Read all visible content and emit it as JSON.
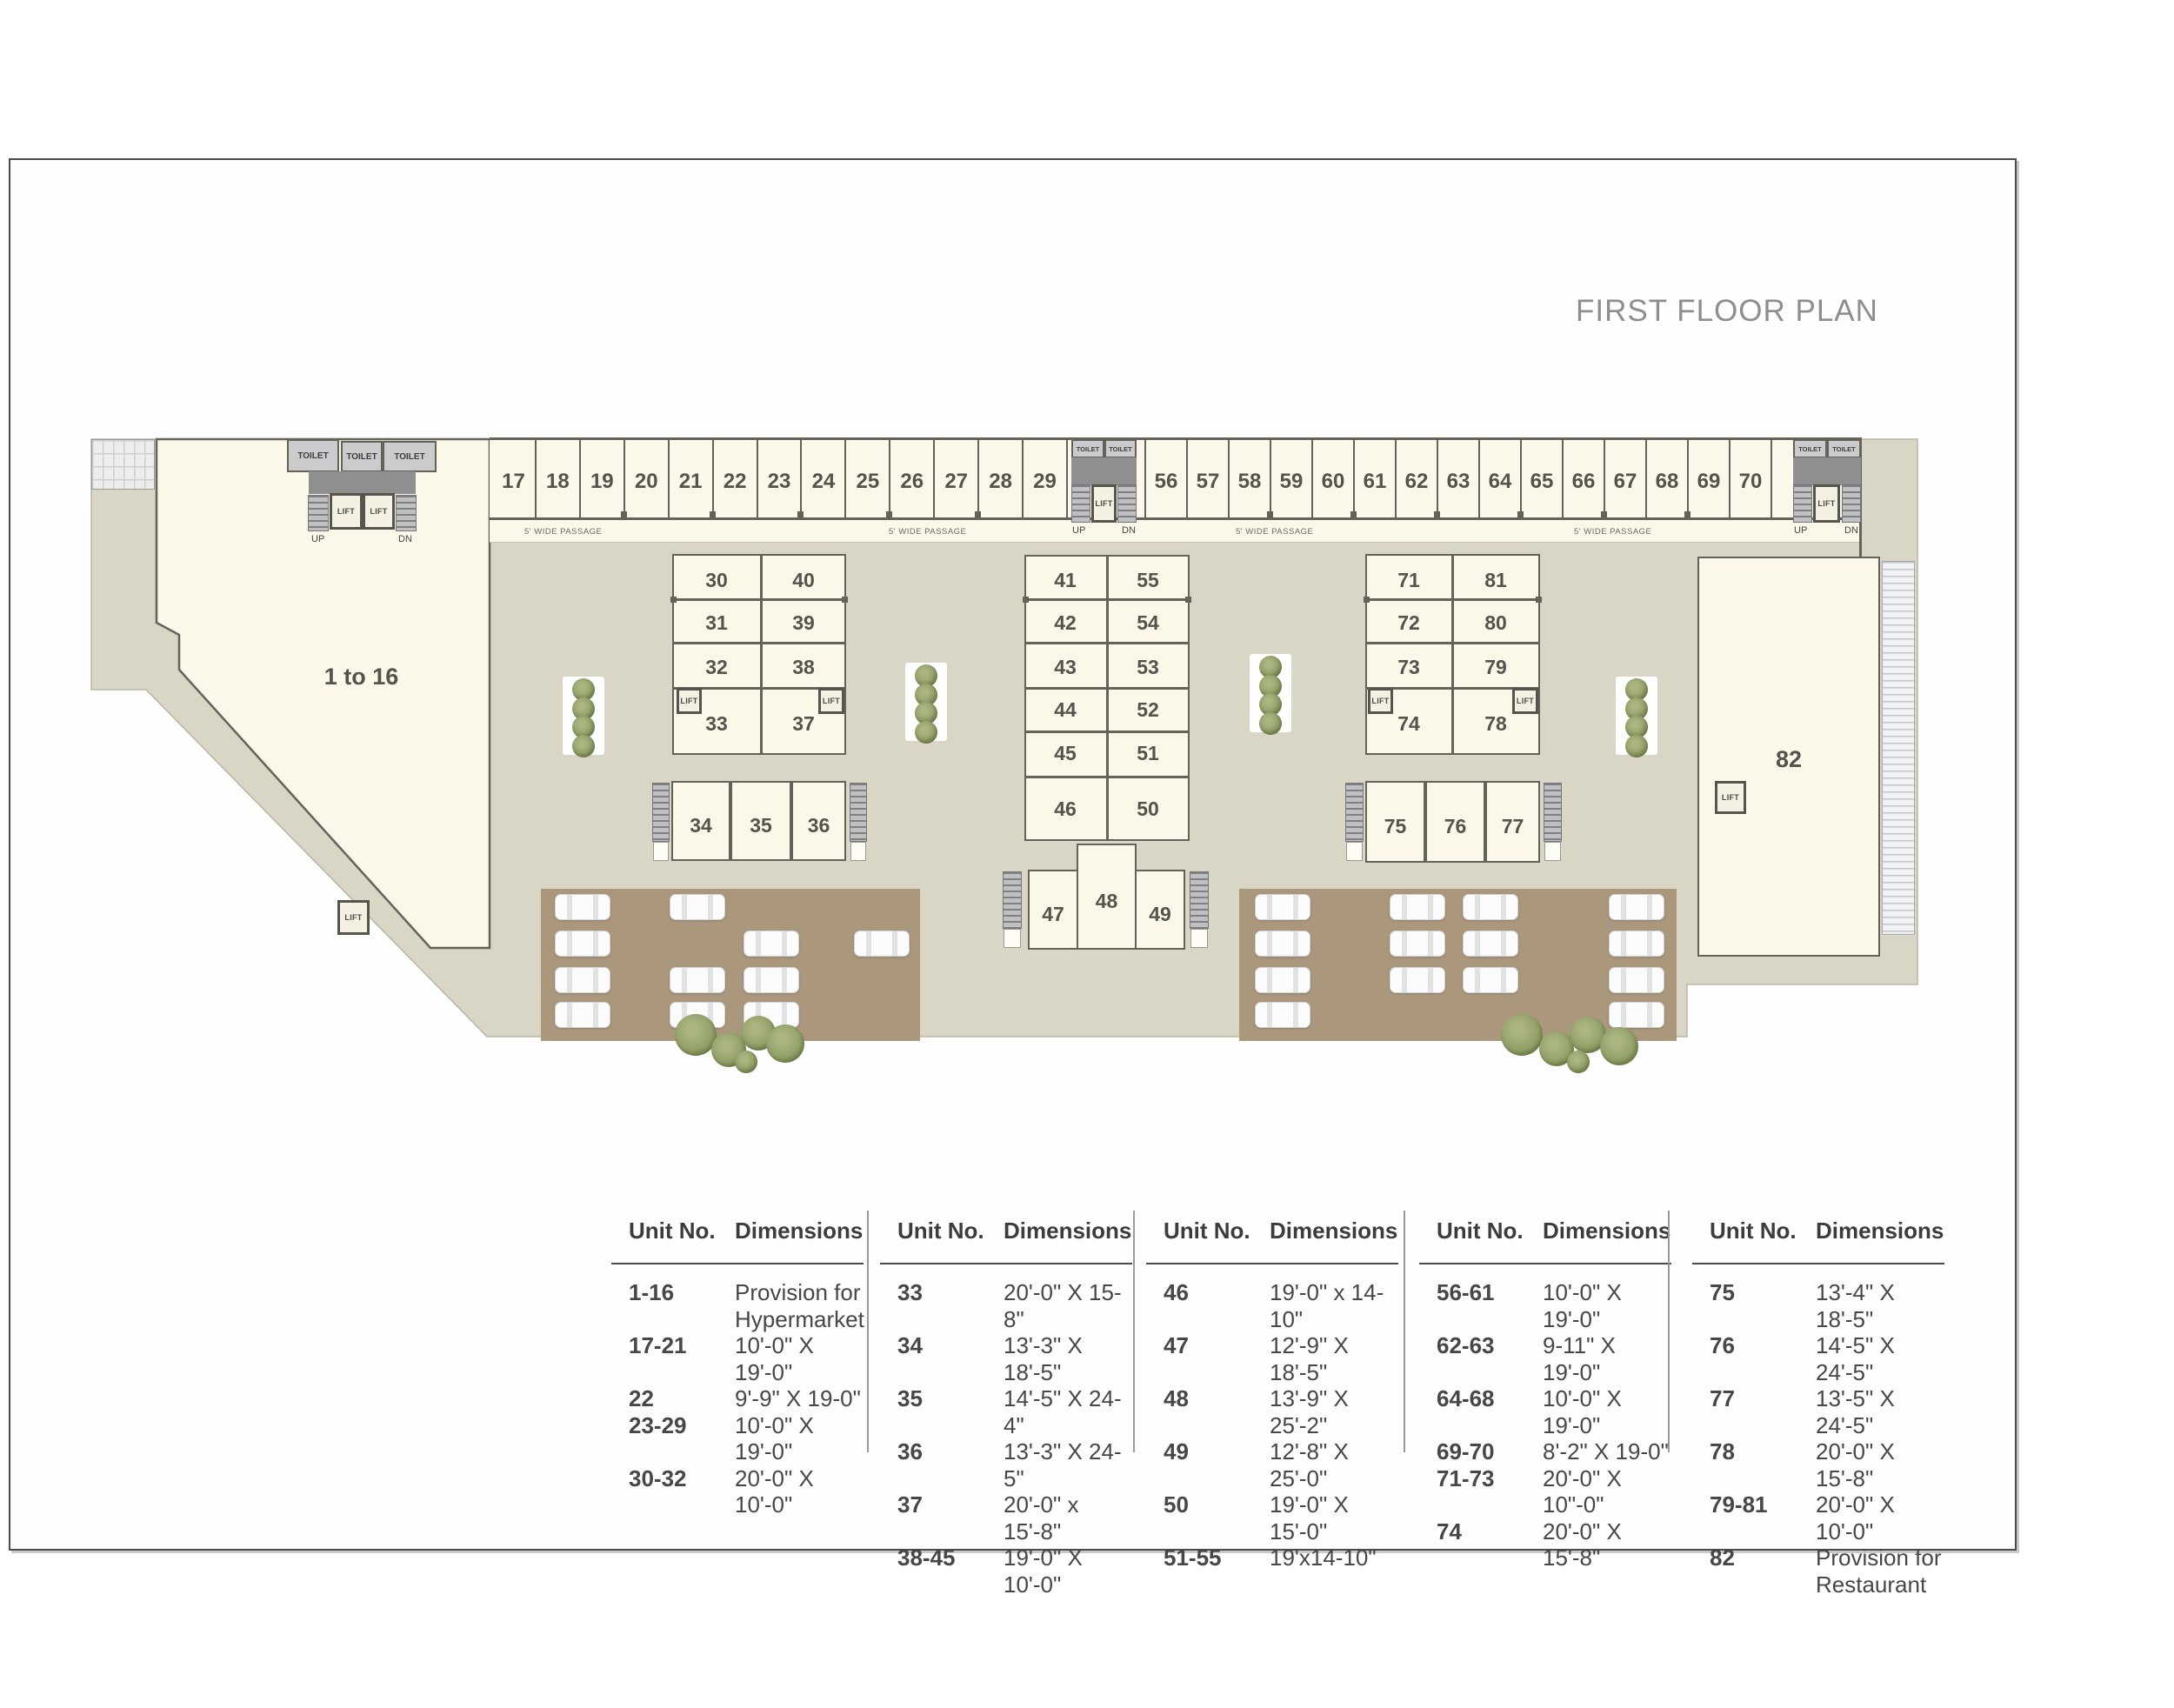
{
  "title": "FIRST FLOOR PLAN",
  "plan": {
    "labels": {
      "toilet": "TOILET",
      "lift": "LIFT",
      "up": "UP",
      "dn": "DN",
      "passage": "5' WIDE PASSAGE",
      "area_hypermarket": "1 to 16",
      "area_restaurant": "82"
    },
    "top_row_a": [
      "17",
      "18",
      "19",
      "20",
      "21",
      "22",
      "23",
      "24",
      "25",
      "26",
      "27",
      "28",
      "29"
    ],
    "top_row_b": [
      "56",
      "57",
      "58",
      "59",
      "60",
      "61",
      "62",
      "63",
      "64",
      "65",
      "66",
      "67",
      "68",
      "69",
      "70"
    ],
    "block1": {
      "left": [
        "30",
        "31",
        "32",
        "33"
      ],
      "right": [
        "40",
        "39",
        "38",
        "37"
      ],
      "bottom": [
        "34",
        "35",
        "36"
      ]
    },
    "block2": {
      "left": [
        "41",
        "42",
        "43",
        "44",
        "45",
        "46"
      ],
      "right": [
        "55",
        "54",
        "53",
        "52",
        "51",
        "50"
      ],
      "bottom": [
        "47",
        "48",
        "49"
      ]
    },
    "block3": {
      "left": [
        "71",
        "72",
        "73",
        "74"
      ],
      "right": [
        "81",
        "80",
        "79",
        "78"
      ],
      "bottom": [
        "75",
        "76",
        "77"
      ]
    }
  },
  "table": {
    "unit_header": "Unit No.",
    "dim_header": "Dimensions",
    "groups": [
      [
        {
          "u": "1-16",
          "d": "Provision for\nHypermarket"
        },
        {
          "u": "17-21",
          "d": "10'-0\" X 19'-0\""
        },
        {
          "u": "22",
          "d": "9'-9\" X 19-0\""
        },
        {
          "u": "23-29",
          "d": "10'-0\" X 19'-0\""
        },
        {
          "u": "30-32",
          "d": "20'-0\" X 10'-0\""
        }
      ],
      [
        {
          "u": "33",
          "d": "20'-0\" X 15-8\""
        },
        {
          "u": "34",
          "d": "13'-3\" X 18'-5\""
        },
        {
          "u": "35",
          "d": "14'-5\" X 24-4\""
        },
        {
          "u": "36",
          "d": "13'-3\" X 24-5\""
        },
        {
          "u": "37",
          "d": "20'-0\" x 15'-8\""
        },
        {
          "u": "38-45",
          "d": "19'-0\" X 10'-0\""
        }
      ],
      [
        {
          "u": "46",
          "d": "19'-0\" x 14-10\""
        },
        {
          "u": "47",
          "d": "12'-9\" X 18'-5\""
        },
        {
          "u": "48",
          "d": "13'-9\" X 25'-2\""
        },
        {
          "u": "49",
          "d": "12'-8\" X 25'-0\""
        },
        {
          "u": "50",
          "d": "19'-0\" X 15'-0\""
        },
        {
          "u": "51-55",
          "d": "19'x14-10\""
        }
      ],
      [
        {
          "u": "56-61",
          "d": "10'-0\" X 19'-0\""
        },
        {
          "u": "62-63",
          "d": "9-11\" X 19'-0\""
        },
        {
          "u": "64-68",
          "d": "10'-0\" X 19'-0\""
        },
        {
          "u": "69-70",
          "d": "8'-2\" X 19-0\""
        },
        {
          "u": "71-73",
          "d": "20'-0\" X 10\"-0\""
        },
        {
          "u": "74",
          "d": "20'-0\" X 15'-8\""
        }
      ],
      [
        {
          "u": "75",
          "d": "13'-4\" X 18'-5\""
        },
        {
          "u": "76",
          "d": "14'-5\" X 24'-5\""
        },
        {
          "u": "77",
          "d": "13'-5\" X 24'-5\""
        },
        {
          "u": "78",
          "d": "20'-0\" X 15'-8\""
        },
        {
          "u": "79-81",
          "d": "20'-0\" X 10'-0\""
        },
        {
          "u": "82",
          "d": "Provision for\nRestaurant"
        }
      ]
    ]
  },
  "colors": {
    "ground": "#d9d6c5",
    "unit_fill": "#fbf8e9",
    "wall": "#63635a",
    "parking": "#ab977c",
    "tree": "#8b9962",
    "title_text": "#8e8e8e"
  }
}
